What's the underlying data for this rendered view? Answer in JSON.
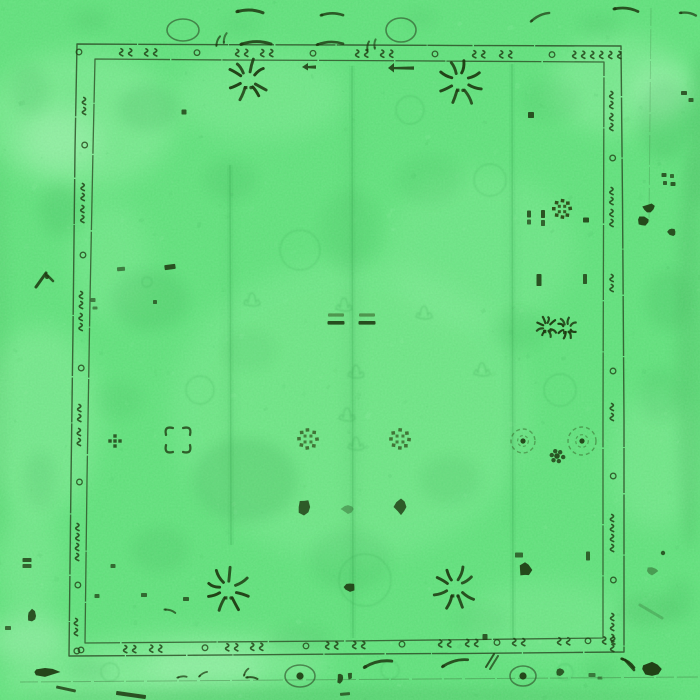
{
  "meta": {
    "description": "Top-down photograph of an emerald green overdyed distressed oriental Oushak rug with dark olive floral motifs, double-line hand-drawn border and faded ghost pattern",
    "width": 700,
    "height": 700
  },
  "palette": {
    "base": "#60e37c",
    "light": "#8ef2a0",
    "lighter": "#abf7b8",
    "shade": "#3fae57",
    "ghost": "#2f9c4a",
    "line": "#2b4a24",
    "dark": "#1d3810",
    "dark2": "#2c4a16"
  },
  "rug": {
    "outer_border_points": "77,44 200,44.6 350,45 490,45.6 621,46 622.5,200 624,420 624,652 470,653.4 350,654 200,655.2 69,656 71,480 73,330 75,150",
    "inner_border_points": "95,59 230,60 350,60.5 480,61.3 604,62 603.6,200 603,420 603,638 470,639.6 344,641 210,642 85,643 87,480 90,300 93,150",
    "band": {
      "top": {
        "items": [
          [
            "c",
            79
          ],
          [
            "s",
            127
          ],
          [
            "s",
            152
          ],
          [
            "c",
            197
          ],
          [
            "s",
            243
          ],
          [
            "s",
            268
          ],
          [
            "c",
            313
          ],
          [
            "s",
            363
          ],
          [
            "s",
            388
          ],
          [
            "c",
            435
          ],
          [
            "s",
            480
          ],
          [
            "s",
            507
          ],
          [
            "c",
            552
          ],
          [
            "s",
            580
          ],
          [
            "s",
            598
          ],
          [
            "s",
            616
          ]
        ]
      },
      "bottom": {
        "items": [
          [
            "c",
            81
          ],
          [
            "s",
            131
          ],
          [
            "s",
            157
          ],
          [
            "c",
            205
          ],
          [
            "s",
            233
          ],
          [
            "s",
            258
          ],
          [
            "c",
            306
          ],
          [
            "s",
            333
          ],
          [
            "s",
            360
          ],
          [
            "c",
            402
          ],
          [
            "s",
            446
          ],
          [
            "s",
            473
          ],
          [
            "c",
            497
          ],
          [
            "s",
            520
          ],
          [
            "s",
            565
          ],
          [
            "c",
            588
          ],
          [
            "s",
            610
          ]
        ]
      },
      "left": {
        "items": [
          [
            "s",
            106
          ],
          [
            "c",
            145
          ],
          [
            "s",
            192
          ],
          [
            "s",
            214
          ],
          [
            "c",
            255
          ],
          [
            "s",
            300
          ],
          [
            "s",
            322
          ],
          [
            "c",
            368
          ],
          [
            "s",
            413
          ],
          [
            "s",
            437
          ],
          [
            "c",
            482
          ],
          [
            "s",
            532
          ],
          [
            "s",
            552
          ],
          [
            "c",
            585
          ],
          [
            "s",
            627
          ],
          [
            "c",
            651
          ]
        ]
      },
      "right": {
        "items": [
          [
            "s",
            100
          ],
          [
            "s",
            122
          ],
          [
            "c",
            158
          ],
          [
            "s",
            196
          ],
          [
            "s",
            218
          ],
          [
            "s",
            283
          ],
          [
            "c",
            371
          ],
          [
            "s",
            412
          ],
          [
            "c",
            476
          ],
          [
            "s",
            523
          ],
          [
            "s",
            543
          ],
          [
            "c",
            580
          ],
          [
            "s",
            622
          ],
          [
            "s",
            643
          ]
        ]
      }
    },
    "creases": [
      [
        230,
        165,
        545
      ],
      [
        352,
        66,
        638
      ],
      [
        512,
        64,
        640
      ]
    ],
    "guard_lines": [
      [
        20,
        682,
        698,
        677,
        0.3
      ],
      [
        651,
        8,
        649,
        222,
        0.18
      ]
    ]
  },
  "wash": {
    "light": [
      [
        80,
        120,
        95,
        70,
        0.5
      ],
      [
        40,
        420,
        60,
        95,
        0.45
      ],
      [
        350,
        410,
        180,
        150,
        0.3
      ],
      [
        620,
        85,
        70,
        50,
        0.5
      ],
      [
        200,
        662,
        130,
        30,
        0.5
      ],
      [
        480,
        250,
        95,
        80,
        0.28
      ],
      [
        655,
        460,
        45,
        70,
        0.35
      ],
      [
        95,
        682,
        95,
        22,
        0.5
      ],
      [
        260,
        95,
        85,
        45,
        0.35
      ],
      [
        545,
        620,
        80,
        40,
        0.3
      ],
      [
        110,
        260,
        40,
        60,
        0.3
      ],
      [
        30,
        560,
        30,
        60,
        0.35
      ]
    ],
    "lighter": [
      [
        60,
        140,
        40,
        30,
        0.5
      ],
      [
        30,
        640,
        40,
        25,
        0.5
      ],
      [
        205,
        665,
        60,
        18,
        0.5
      ],
      [
        660,
        90,
        30,
        24,
        0.5
      ]
    ],
    "shade": [
      [
        690,
        350,
        14,
        200,
        0.25
      ],
      [
        352,
        350,
        8,
        280,
        0.12
      ],
      [
        700,
        130,
        10,
        80,
        0.3
      ],
      [
        0,
        350,
        8,
        200,
        0.15
      ],
      [
        350,
        697,
        330,
        10,
        0.25
      ],
      [
        230,
        350,
        5,
        190,
        0.12
      ],
      [
        512,
        350,
        5,
        190,
        0.12
      ],
      [
        648,
        610,
        30,
        16,
        0.2
      ]
    ]
  },
  "ghosts": {
    "blobs": [
      [
        148,
        108,
        30,
        22,
        0.14
      ],
      [
        150,
        300,
        38,
        30,
        0.13
      ],
      [
        245,
        480,
        52,
        42,
        0.16
      ],
      [
        230,
        180,
        26,
        20,
        0.1
      ],
      [
        350,
        230,
        30,
        40,
        0.08
      ],
      [
        520,
        330,
        26,
        20,
        0.08
      ],
      [
        430,
        180,
        32,
        24,
        0.08
      ],
      [
        450,
        480,
        30,
        24,
        0.1
      ],
      [
        350,
        560,
        40,
        30,
        0.1
      ],
      [
        160,
        550,
        28,
        22,
        0.1
      ],
      [
        60,
        210,
        20,
        26,
        0.12
      ],
      [
        665,
        120,
        26,
        40,
        0.14
      ],
      [
        668,
        300,
        22,
        30,
        0.12
      ],
      [
        660,
        395,
        20,
        26,
        0.1
      ],
      [
        30,
        90,
        18,
        24,
        0.1
      ],
      [
        40,
        480,
        16,
        28,
        0.1
      ],
      [
        250,
        350,
        26,
        20,
        0.07
      ],
      [
        550,
        100,
        30,
        20,
        0.08
      ],
      [
        120,
        400,
        22,
        18,
        0.08
      ],
      [
        300,
        640,
        30,
        14,
        0.1
      ],
      [
        480,
        620,
        26,
        14,
        0.08
      ],
      [
        90,
        670,
        20,
        10,
        0.12
      ],
      [
        600,
        670,
        16,
        10,
        0.1
      ],
      [
        680,
        600,
        14,
        20,
        0.1
      ],
      [
        90,
        20,
        18,
        10,
        0.1
      ],
      [
        600,
        25,
        20,
        10,
        0.1
      ],
      [
        420,
        18,
        16,
        8,
        0.08
      ],
      [
        240,
        25,
        18,
        8,
        0.08
      ]
    ],
    "rings": [
      [
        365,
        580,
        26
      ],
      [
        300,
        250,
        20
      ],
      [
        410,
        110,
        14
      ],
      [
        490,
        180,
        16
      ],
      [
        200,
        390,
        14
      ],
      [
        560,
        390,
        16
      ],
      [
        110,
        672,
        9
      ],
      [
        390,
        670,
        9
      ],
      [
        565,
        672,
        8
      ],
      [
        147,
        282,
        5
      ]
    ],
    "crowns": [
      [
        342,
        305
      ],
      [
        354,
        372
      ],
      [
        422,
        313
      ],
      [
        354,
        444
      ],
      [
        250,
        300
      ],
      [
        480,
        370
      ],
      [
        345,
        415
      ]
    ]
  },
  "motifs": {
    "sprays": [
      [
        248,
        80,
        20
      ],
      [
        460,
        82,
        22
      ],
      [
        228,
        590,
        21
      ],
      [
        455,
        588,
        21
      ],
      [
        547,
        327,
        10
      ],
      [
        567,
        328,
        10
      ]
    ],
    "sq_rosettes": [
      [
        562,
        209,
        10,
        0.95
      ],
      [
        308,
        439,
        11,
        0.72
      ],
      [
        400,
        439,
        11,
        0.72
      ]
    ],
    "comma_rosettes": [
      [
        178,
        440,
        13
      ]
    ],
    "cross_flowers": [
      [
        115,
        441
      ]
    ],
    "flower_outlines": [
      [
        523,
        441,
        12
      ],
      [
        582,
        441,
        14
      ]
    ],
    "clusters": [
      [
        557,
        456,
        9
      ]
    ],
    "arrows": [
      [
        388,
        68,
        26,
        7
      ],
      [
        302,
        67,
        14,
        5
      ]
    ],
    "ellipse_outlines": [
      [
        183,
        30,
        16,
        11,
        0
      ],
      [
        401,
        30,
        15,
        12,
        0
      ],
      [
        300,
        676,
        15,
        11,
        1
      ],
      [
        523,
        676,
        13,
        10,
        1
      ]
    ],
    "swashes": [
      [
        250,
        12,
        26,
        8,
        3,
        0.85
      ],
      [
        332,
        15,
        22,
        6,
        2.6,
        0.8
      ],
      [
        256,
        44,
        30,
        4,
        3,
        0.85
      ],
      [
        330,
        44,
        26,
        3,
        2.6,
        0.8
      ],
      [
        218,
        41,
        10,
        -55,
        2,
        0.7
      ],
      [
        225,
        38,
        10,
        -60,
        2,
        0.6
      ],
      [
        540,
        17,
        20,
        -18,
        2.4,
        0.7
      ],
      [
        626,
        10,
        24,
        12,
        2.8,
        0.85
      ],
      [
        688,
        14,
        16,
        18,
        2.4,
        0.7
      ],
      [
        368,
        46,
        9,
        -65,
        2,
        0.7
      ],
      [
        375,
        44,
        9,
        -70,
        2,
        0.6
      ],
      [
        378,
        664,
        28,
        -8,
        3,
        0.85
      ],
      [
        455,
        663,
        26,
        -10,
        2.8,
        0.85
      ],
      [
        252,
        678,
        11,
        20,
        2,
        0.8
      ],
      [
        246,
        672,
        8,
        -40,
        1.8,
        0.7
      ],
      [
        170,
        611,
        11,
        30,
        2,
        0.7
      ],
      [
        628,
        663,
        15,
        45,
        2.6,
        0.9
      ],
      [
        182,
        677,
        9,
        10,
        1.8,
        0.7
      ],
      [
        203,
        674,
        9,
        -15,
        1.8,
        0.7
      ]
    ],
    "blobs": [
      [
        45,
        672,
        26,
        8,
        0,
        0.92
      ],
      [
        32,
        616,
        9,
        12,
        0,
        0.85
      ],
      [
        304,
        507,
        13,
        17,
        0,
        0.8
      ],
      [
        401,
        507,
        12,
        15,
        0,
        0.8
      ],
      [
        348,
        509,
        12,
        9,
        0,
        0.35
      ],
      [
        525,
        570,
        13,
        13,
        0,
        0.9
      ],
      [
        350,
        587,
        12,
        8,
        0,
        0.88
      ],
      [
        652,
        669,
        20,
        14,
        0,
        0.95
      ],
      [
        649,
        208,
        13,
        9,
        -20,
        0.9
      ],
      [
        643,
        221,
        12,
        10,
        15,
        0.9
      ],
      [
        672,
        232,
        9,
        7,
        40,
        0.85
      ],
      [
        652,
        571,
        10,
        8,
        0,
        0.4
      ],
      [
        340,
        678,
        6,
        10,
        0,
        0.85
      ],
      [
        350,
        676,
        5,
        8,
        0,
        0.8
      ],
      [
        560,
        672,
        8,
        9,
        0,
        0.8
      ]
    ],
    "marks": [
      [
        184,
        112,
        5,
        5,
        0,
        0.8
      ],
      [
        531,
        115,
        6,
        6,
        0,
        0.85
      ],
      [
        586,
        220,
        6,
        5,
        0,
        0.85
      ],
      [
        529,
        214,
        4,
        7,
        0,
        0.8
      ],
      [
        529,
        222,
        4,
        5,
        0,
        0.7
      ],
      [
        543,
        214,
        4,
        8,
        0,
        0.85
      ],
      [
        543,
        223,
        4,
        6,
        0,
        0.75
      ],
      [
        539,
        280,
        5,
        12,
        0,
        0.85
      ],
      [
        585,
        279,
        4,
        10,
        0,
        0.8
      ],
      [
        519,
        555,
        8,
        5,
        0,
        0.7
      ],
      [
        588,
        556,
        4,
        9,
        0,
        0.75
      ],
      [
        113,
        566,
        5,
        4,
        0,
        0.7
      ],
      [
        97,
        596,
        5,
        4,
        0,
        0.7
      ],
      [
        144,
        595,
        6,
        4,
        0,
        0.7
      ],
      [
        186,
        599,
        6,
        4,
        0,
        0.75
      ],
      [
        485,
        637,
        5,
        6,
        0,
        0.8
      ],
      [
        170,
        267,
        11,
        5,
        -8,
        0.85
      ],
      [
        121,
        269,
        8,
        4,
        -5,
        0.6
      ],
      [
        155,
        302,
        4,
        4,
        0,
        0.7
      ],
      [
        93,
        300,
        5,
        4,
        0,
        0.6
      ],
      [
        95,
        308,
        5,
        3,
        0,
        0.55
      ],
      [
        27,
        560,
        9,
        4,
        0,
        0.8
      ],
      [
        27,
        566,
        9,
        4,
        0,
        0.75
      ],
      [
        8,
        628,
        6,
        4,
        0,
        0.7
      ],
      [
        664,
        175,
        5,
        4,
        0,
        0.8
      ],
      [
        672,
        176,
        4,
        4,
        0,
        0.7
      ],
      [
        665,
        183,
        4,
        4,
        0,
        0.75
      ],
      [
        673,
        184,
        5,
        4,
        0,
        0.8
      ],
      [
        684,
        93,
        6,
        4,
        0,
        0.8
      ],
      [
        691,
        100,
        5,
        4,
        0,
        0.75
      ],
      [
        131,
        695,
        30,
        4,
        8,
        0.85
      ],
      [
        66,
        689,
        20,
        3,
        12,
        0.8
      ],
      [
        345,
        694,
        10,
        3,
        -5,
        0.7
      ],
      [
        592,
        675,
        7,
        4,
        0,
        0.6
      ],
      [
        600,
        678,
        5,
        3,
        0,
        0.5
      ]
    ],
    "eq_pairs": [
      [
        336,
        315
      ],
      [
        367,
        315
      ]
    ],
    "dots": [
      [
        663,
        553,
        2.2,
        0.8
      ],
      [
        47,
        277,
        2,
        0.85
      ]
    ],
    "strokes": [
      [
        36,
        287,
        46,
        273,
        3,
        0.85
      ],
      [
        46,
        274,
        53,
        281,
        2.6,
        0.8
      ],
      [
        486,
        667,
        494,
        654,
        2,
        0.8
      ],
      [
        490,
        669,
        498,
        656,
        2,
        0.7
      ],
      [
        640,
        605,
        662,
        618,
        3,
        0.2
      ],
      [
        625,
        660,
        634,
        670,
        2.6,
        0.85
      ]
    ]
  }
}
